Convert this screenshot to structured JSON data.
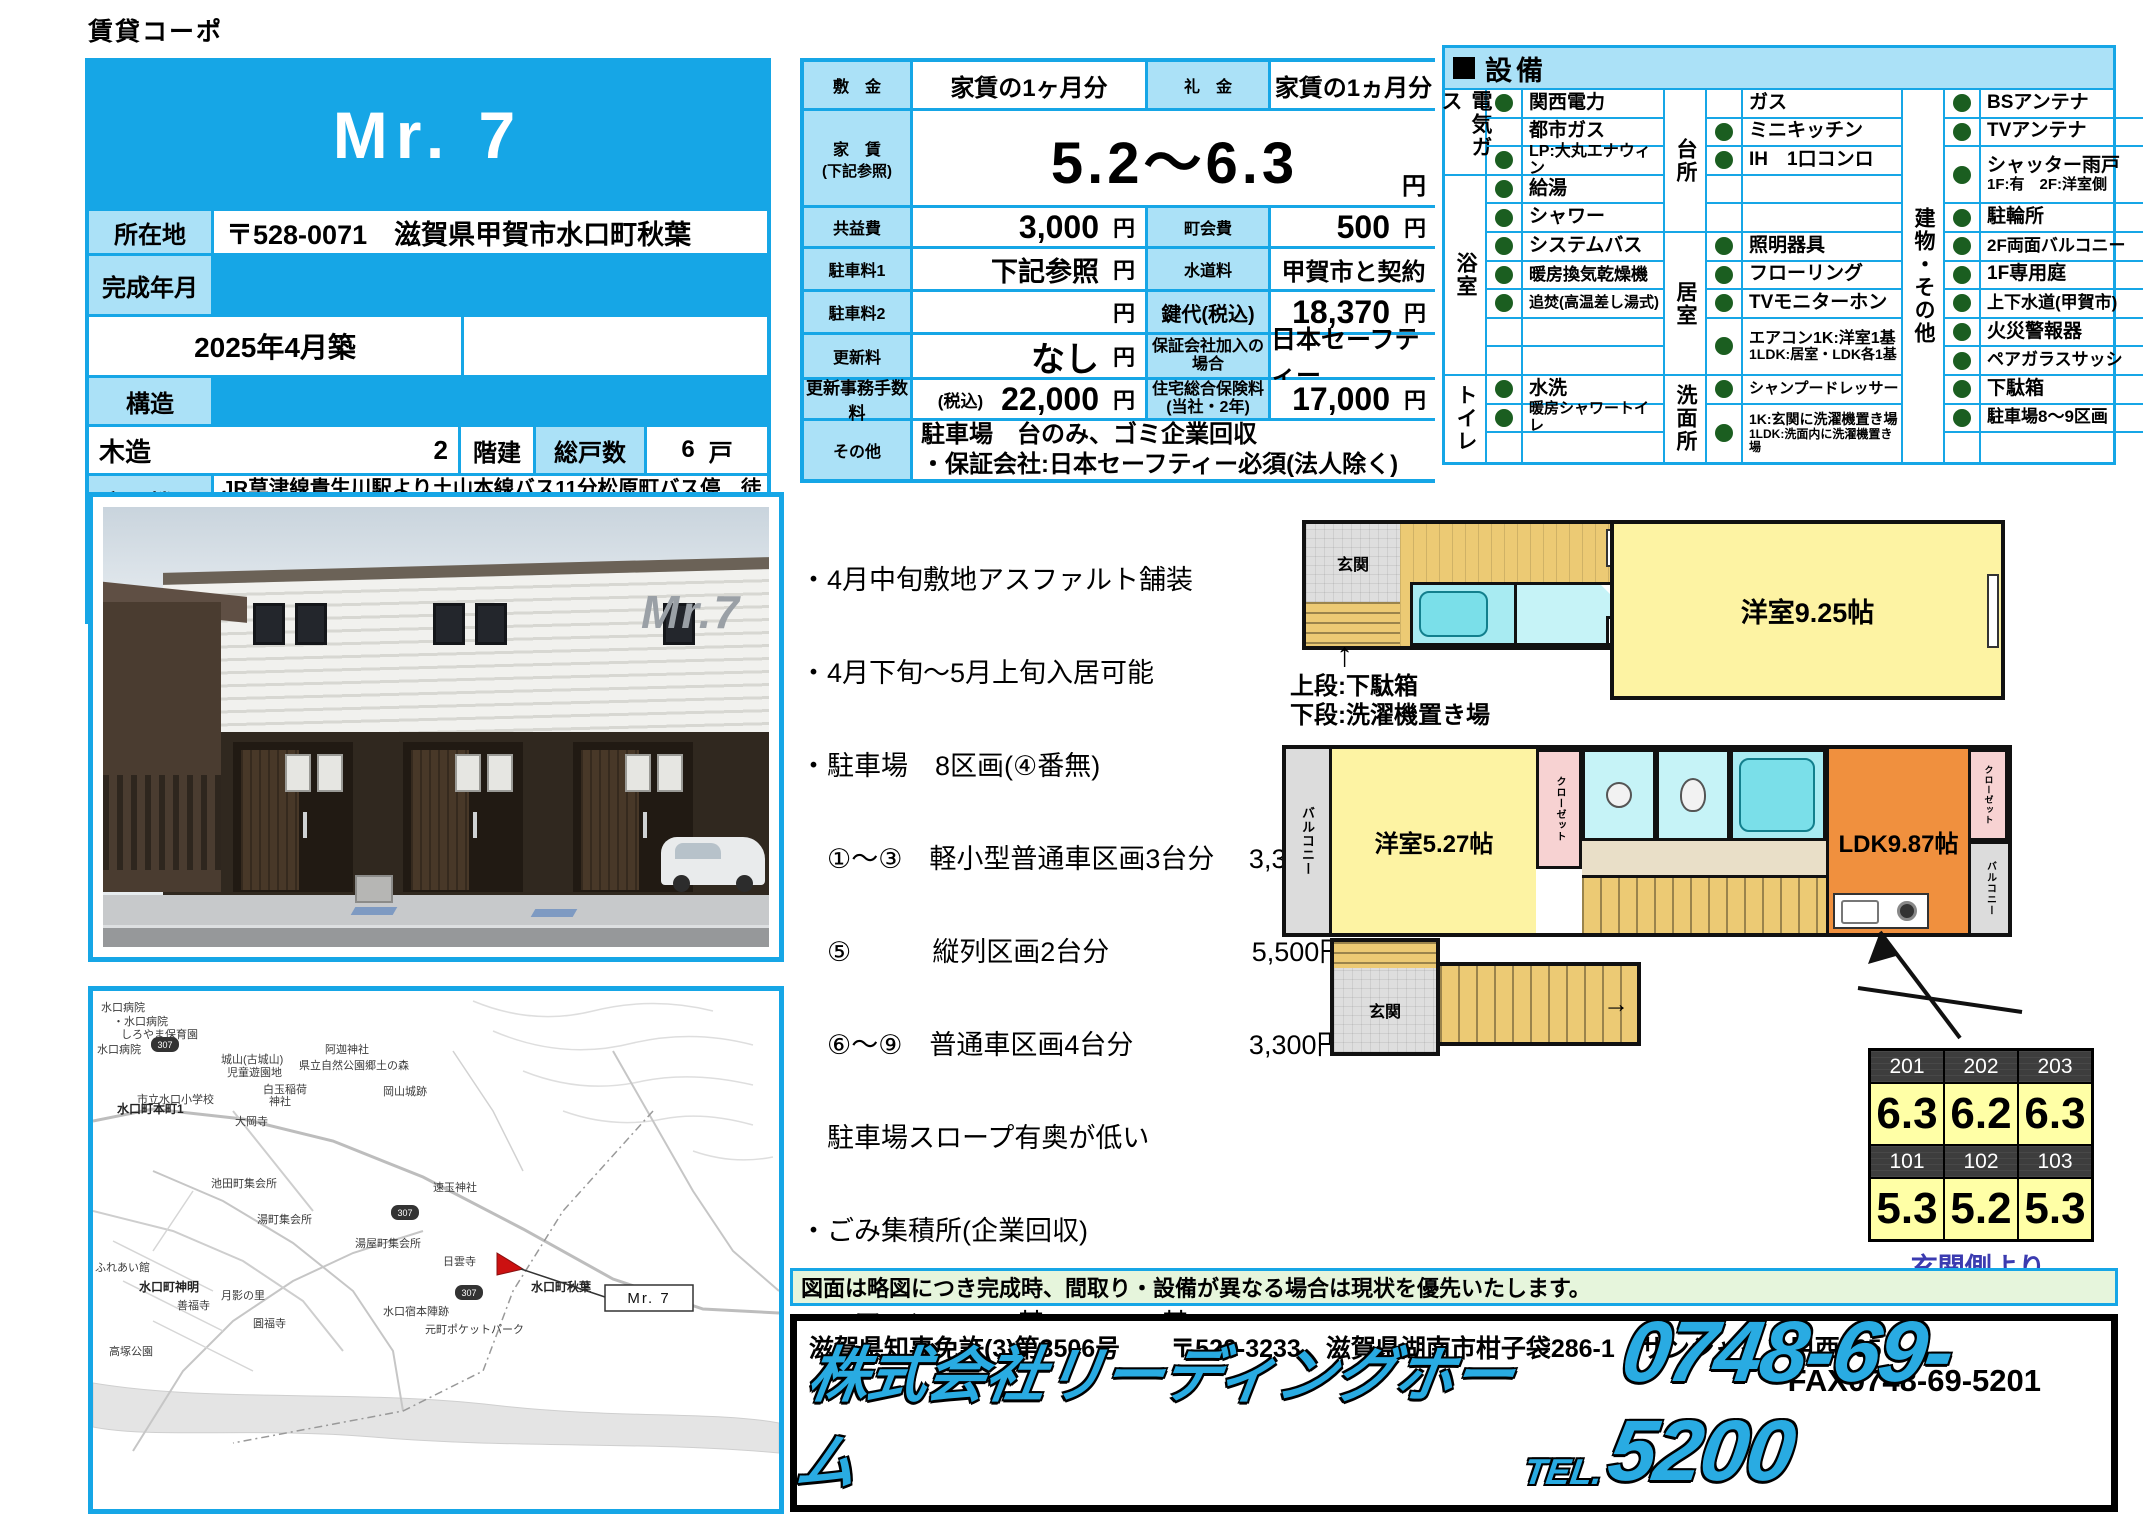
{
  "page": {
    "top_label": "賃貸コーポ"
  },
  "property": {
    "title": "Mr. 7",
    "location_label": "所在地",
    "location_value": "〒528-0071　滋賀県甲賀市水口町秋葉",
    "built_label": "完成年月",
    "built_value": "2025年4月築",
    "structure_label": "構造",
    "structure_value": "木造",
    "structure_floors_num": "2",
    "floors_label": "階建",
    "units_label": "総戸数",
    "units_value": "6",
    "units_unit": "戸",
    "transport_label": "交通機関",
    "transport_value": "JR草津線貴生川駅より土山本線バス11分松原町バス停　徒歩2分",
    "contract_label": "契約期間",
    "contract_value": "2年",
    "area_label": "専有面積",
    "area_value": "27.12〜41.41",
    "area_unit": "㎡"
  },
  "fees": {
    "shikikin_label": "敷　金",
    "shikikin_value": "家賃の1ヶ月分",
    "reikin_label": "礼　金",
    "reikin_value": "家賃の1ヵ月分",
    "yachin_label": "家　賃",
    "yachin_note": "(下記参照)",
    "yachin_value": "5.2〜6.3",
    "yen": "円",
    "kyoekihi_label": "共益費",
    "kyoekihi_value": "3,000",
    "chokaihi_label": "町会費",
    "chokaihi_value": "500",
    "parking1_label": "駐車料1",
    "parking1_value": "下記参照",
    "suido_label": "水道料",
    "suido_value": "甲賀市と契約",
    "parking2_label": "駐車料2",
    "parking2_value": "",
    "kagidai_label": "鍵代(税込)",
    "kagidai_value": "18,370",
    "koshinryo_label": "更新料",
    "koshinryo_value": "なし",
    "hosho_label": "保証会社加入の場合",
    "hosho_value": "日本セーフティー",
    "jimu_label": "更新事務手数料",
    "jimu_pre": "(税込)",
    "jimu_value": "22,000",
    "hoken_label": "住宅総合保険料",
    "hoken_label2": "(当社・2年)",
    "hoken_value": "17,000",
    "sonota_label": "その他",
    "sonota_line1": "駐車場　台のみ、ゴミ企業回収",
    "sonota_line2": "・保証会社:日本セーフティー必須(法人除く)"
  },
  "equipment": {
    "title": "設備",
    "g1": {
      "cats": [
        "電気ガス",
        "浴室",
        "トイレ"
      ],
      "items": [
        {
          "dot": true,
          "label": "関西電力"
        },
        {
          "dot": false,
          "label": "都市ガス"
        },
        {
          "dot": true,
          "label": "LP:大丸エナウィン"
        },
        {
          "dot": true,
          "label": "給湯"
        },
        {
          "dot": true,
          "label": "シャワー"
        },
        {
          "dot": true,
          "label": "システムバス"
        },
        {
          "dot": true,
          "label": "暖房換気乾燥機"
        },
        {
          "dot": true,
          "label": "追焚(高温差し湯式)"
        },
        {
          "dot": false,
          "label": ""
        },
        {
          "dot": false,
          "label": ""
        },
        {
          "dot": true,
          "label": "水洗"
        },
        {
          "dot": true,
          "label": "暖房シャワートイレ"
        },
        {
          "dot": false,
          "label": ""
        }
      ]
    },
    "g2": {
      "cats": [
        "台所",
        "居室",
        "洗面所"
      ],
      "items": [
        {
          "dot": false,
          "label": "ガス"
        },
        {
          "dot": true,
          "label": "ミニキッチン"
        },
        {
          "dot": true,
          "label": "IH　1口コンロ"
        },
        {
          "dot": false,
          "label": ""
        },
        {
          "dot": false,
          "label": ""
        },
        {
          "dot": true,
          "label": "照明器具"
        },
        {
          "dot": true,
          "label": "フローリング"
        },
        {
          "dot": true,
          "label": "TVモニターホン"
        },
        {
          "dot": true,
          "label": "エアコン1K:洋室1基",
          "sub": "1LDK:居室・LDK各1基"
        },
        {
          "dot": true,
          "label": "シャンプードレッサー"
        },
        {
          "dot": true,
          "label": "1K:玄関に洗濯機置き場",
          "sub": "1LDK:洗面内に洗濯機置き場"
        }
      ]
    },
    "g3": {
      "cats": [
        "建物・その他"
      ],
      "items": [
        {
          "dot": true,
          "label": "BSアンテナ"
        },
        {
          "dot": true,
          "label": "TVアンテナ"
        },
        {
          "dot": true,
          "label": "シャッター雨戸",
          "sub": "1F:有　2F:洋室側"
        },
        {
          "dot": true,
          "label": "駐輪所"
        },
        {
          "dot": true,
          "label": "2F両面バルコニー"
        },
        {
          "dot": true,
          "label": "1F専用庭"
        },
        {
          "dot": true,
          "label": "上下水道(甲賀市)"
        },
        {
          "dot": true,
          "label": "火災警報器"
        },
        {
          "dot": true,
          "label": "ペアガラスサッシ"
        },
        {
          "dot": true,
          "label": "下駄箱"
        },
        {
          "dot": true,
          "label": "駐車場8〜9区画"
        },
        {
          "dot": false,
          "label": ""
        }
      ]
    }
  },
  "notes": {
    "lines": [
      "・4月中旬敷地アスファルト舗装",
      "・4月下旬〜5月上旬入居可能",
      "・駐車場　8区画(④番無)",
      "　①〜③　軽小型普通車区画3台分　 3,300円",
      "　⑤　　　縦列区画2台分　　　　　 5,500円",
      "　⑥〜⑨　普通車区画4台分　　　　 3,300円",
      "　駐車場スロープ有奥が低い",
      "・ごみ集積所(企業回収)",
      "・エアコン　1K:1基　1LDK:2基"
    ]
  },
  "plan1": {
    "genkan": "玄関",
    "ps": "PS",
    "closet": "クローゼット",
    "room": "洋室9.25帖",
    "arrow": "↑",
    "caption1": "上段:下駄箱",
    "caption2": "下段:洗濯機置き場"
  },
  "plan2": {
    "balcony_left": "バルコニー",
    "room": "洋室5.27帖",
    "closet1": "クローゼット",
    "ldk": "LDK9.87帖",
    "closet2": "クローゼット",
    "balcony_right": "バルコニー",
    "genkan": "玄関",
    "stairs_arrow": "→"
  },
  "rooms": {
    "rows": [
      {
        "type": "head",
        "vals": [
          "201",
          "202",
          "203"
        ]
      },
      {
        "type": "val",
        "vals": [
          "6.3",
          "6.2",
          "6.3"
        ]
      },
      {
        "type": "head",
        "vals": [
          "101",
          "102",
          "103"
        ]
      },
      {
        "type": "val",
        "vals": [
          "5.3",
          "5.2",
          "5.3"
        ]
      }
    ],
    "caption": "玄関側より"
  },
  "disclaimer": "図面は略図につき完成時、間取り・設備が異なる場合は現状を優先いたします。",
  "company": {
    "license": "滋賀県知事免許(3)第3506号　　〒520-3233　滋賀県湖南市柑子袋286-1　サンシャイン甲西105",
    "fax": "FAX0748-69-5201",
    "name": "株式会社リーディングホーム",
    "tel_prefix": "TEL.",
    "tel": "0748-69-5200"
  },
  "photo": {
    "logo": "Mr.7"
  },
  "map": {
    "route_no": "307",
    "marker_label": "Mr. 7",
    "labels": [
      {
        "t": "水口病院"
      },
      {
        "t": "・水口病院"
      },
      {
        "t": "しろやま保育園"
      },
      {
        "t": "水口病院"
      },
      {
        "t": "城山(古城山)"
      },
      {
        "t": "児童遊園地"
      },
      {
        "t": "阿迦神社"
      },
      {
        "t": "県立自然公園郷土の森"
      },
      {
        "t": "白玉稲荷"
      },
      {
        "t": "神社"
      },
      {
        "t": "市立水口小学校"
      },
      {
        "t": "岡山城跡"
      },
      {
        "t": "水口町本町1"
      },
      {
        "t": "大岡寺"
      },
      {
        "t": "池田町集会所"
      },
      {
        "t": "湯町集会所"
      },
      {
        "t": "湯屋町集会所"
      },
      {
        "t": "速玉神社"
      },
      {
        "t": "日雲寺"
      },
      {
        "t": "水口町神明"
      },
      {
        "t": "善福寺"
      },
      {
        "t": "月影の里"
      },
      {
        "t": "圓福寺"
      },
      {
        "t": "水口宿本陣跡"
      },
      {
        "t": "元町ポケットパーク"
      },
      {
        "t": "水口町秋葉"
      },
      {
        "t": "高塚公園"
      },
      {
        "t": "ふれあい館"
      }
    ]
  }
}
